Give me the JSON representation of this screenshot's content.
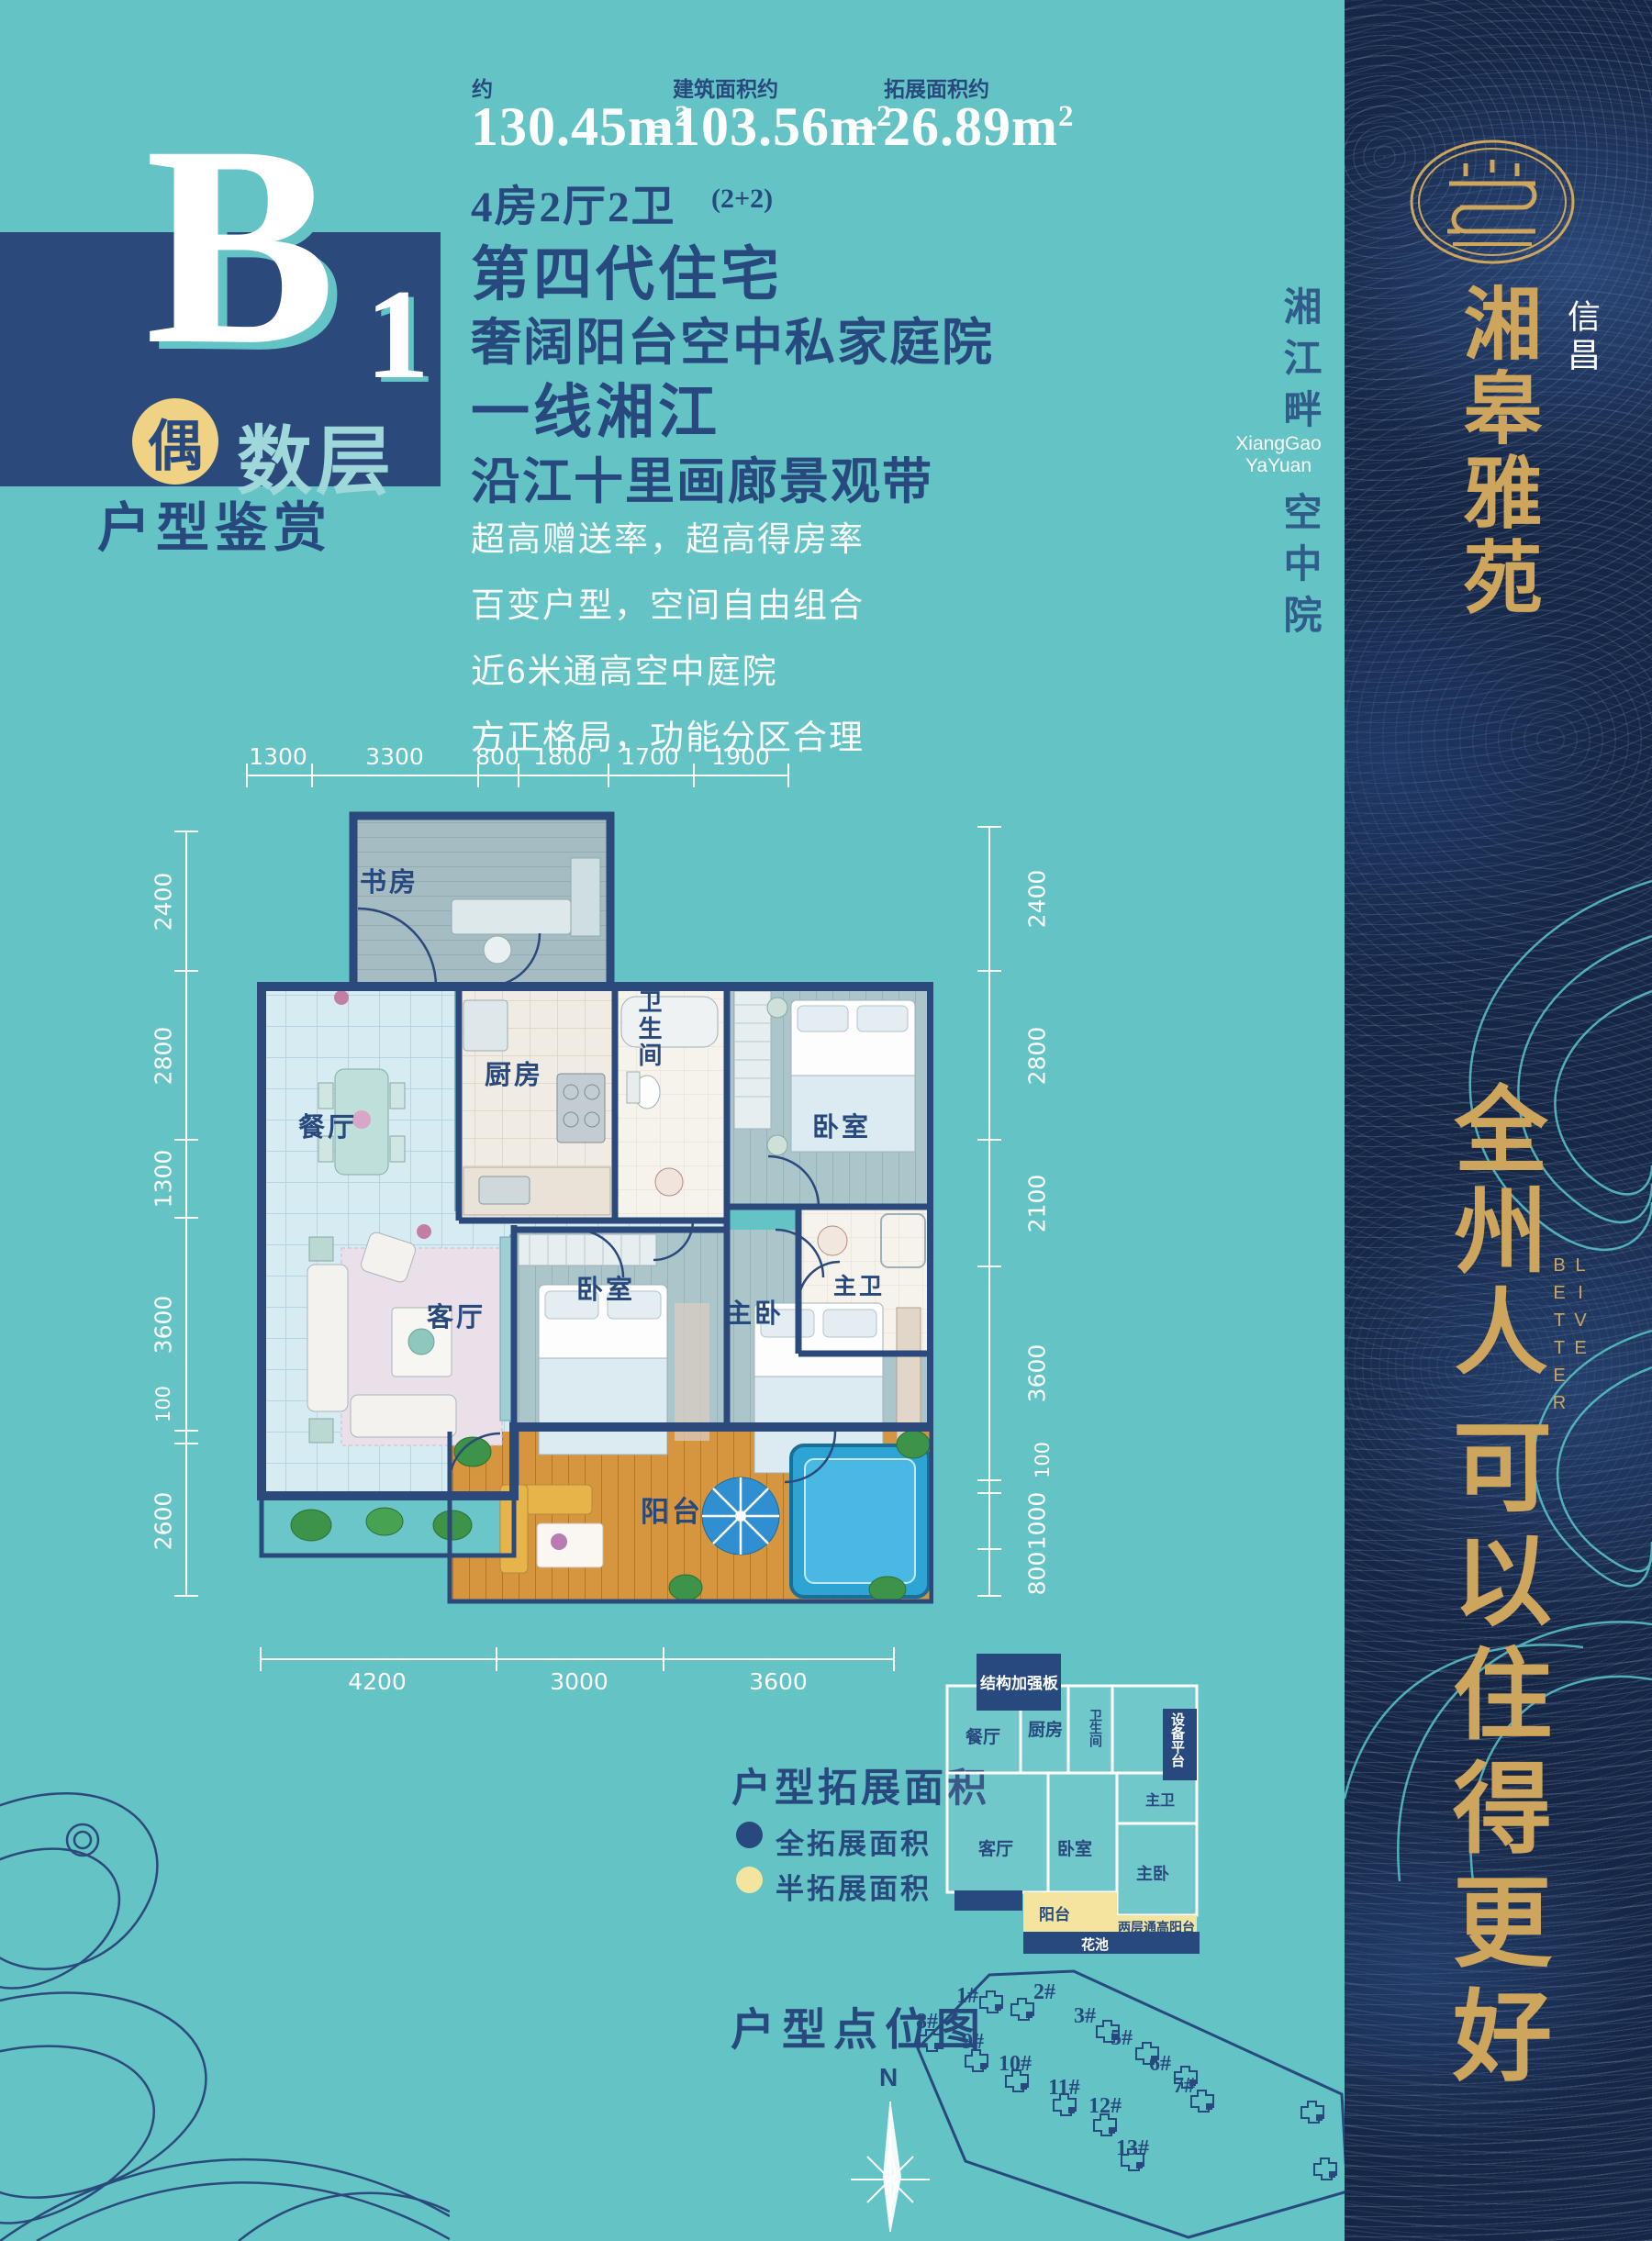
{
  "colors": {
    "teal_bg": "#63c3c5",
    "navy_band": "#2b4a7b",
    "text_navy": "#27497d",
    "panel_navy": "#152646",
    "gold": "#cda55c",
    "badge_yellow": "#f0d285",
    "legend_yellow": "#f3e5a0",
    "contour_teal": "#57bec3"
  },
  "unit": {
    "letter": "B",
    "number": "1",
    "badge": "偶",
    "badge_suffix": "数层",
    "caption": "户型鉴赏"
  },
  "area": {
    "approx_label": "约",
    "total_value": "130.45",
    "unit": "m",
    "sup": "2",
    "equals": "=",
    "built_label": "建筑面积约",
    "built_value": "103.56",
    "plus": "+",
    "expand_label": "拓展面积约",
    "expand_value": "26.89",
    "rooms_line": "4房2厅2卫",
    "rooms_note": "(2+2)"
  },
  "headlines": {
    "h1": "第四代住宅",
    "h2": "奢阔阳台空中私家庭院",
    "h3": "一线湘江",
    "h4": "沿江十里画廊景观带"
  },
  "selling_points": [
    "超高赠送率，超高得房率",
    "百变户型，空间自由组合",
    "近6米通高空中庭院",
    "方正格局，功能分区合理"
  ],
  "floorplan": {
    "dims_top": [
      "1300",
      "3300",
      "800",
      "1800",
      "1700",
      "1900"
    ],
    "dims_left": [
      "2400",
      "2800",
      "1300",
      "3600",
      "100",
      "2600"
    ],
    "dims_right": [
      "2400",
      "2800",
      "2100",
      "3600",
      "100",
      "1000",
      "800"
    ],
    "dims_bottom": [
      "4200",
      "3000",
      "3600"
    ],
    "rooms": {
      "study": "书房",
      "dining": "餐厅",
      "kitchen": "厨房",
      "bath": "卫生间",
      "bedroom1": "卧室",
      "master_bath": "主卫",
      "living": "客厅",
      "bedroom2": "卧室",
      "master": "主卧",
      "balcony": "阳台"
    }
  },
  "expansion": {
    "title": "户型拓展面积",
    "legend_full": "全拓展面积",
    "legend_half": "半拓展面积",
    "labels": {
      "reinforce": "结构加强板",
      "equipment": "设备平台",
      "dining": "餐厅",
      "kitchen": "厨房",
      "bath": "卫生间",
      "master_bath": "主卫",
      "living": "客厅",
      "bedroom": "卧室",
      "master": "主卧",
      "balcony": "阳台",
      "tall_balcony": "两层通高阳台",
      "flower_bed": "花池"
    }
  },
  "sitemap": {
    "title": "户型点位图",
    "compass": "N",
    "buildings": [
      "1#",
      "2#",
      "3#",
      "5#",
      "6#",
      "7#",
      "8#",
      "9#",
      "10#",
      "11#",
      "12#",
      "13#"
    ]
  },
  "brand": {
    "river_line1": "湘江畔",
    "river_line2": "空中院",
    "latin1": "XiangGao",
    "latin2": "YaYuan",
    "developer": "信昌",
    "name": "湘皋雅苑",
    "slogan_top": "全州人",
    "live_better": "LIVE BETTER",
    "slogan_bottom": "可以住得更好"
  }
}
